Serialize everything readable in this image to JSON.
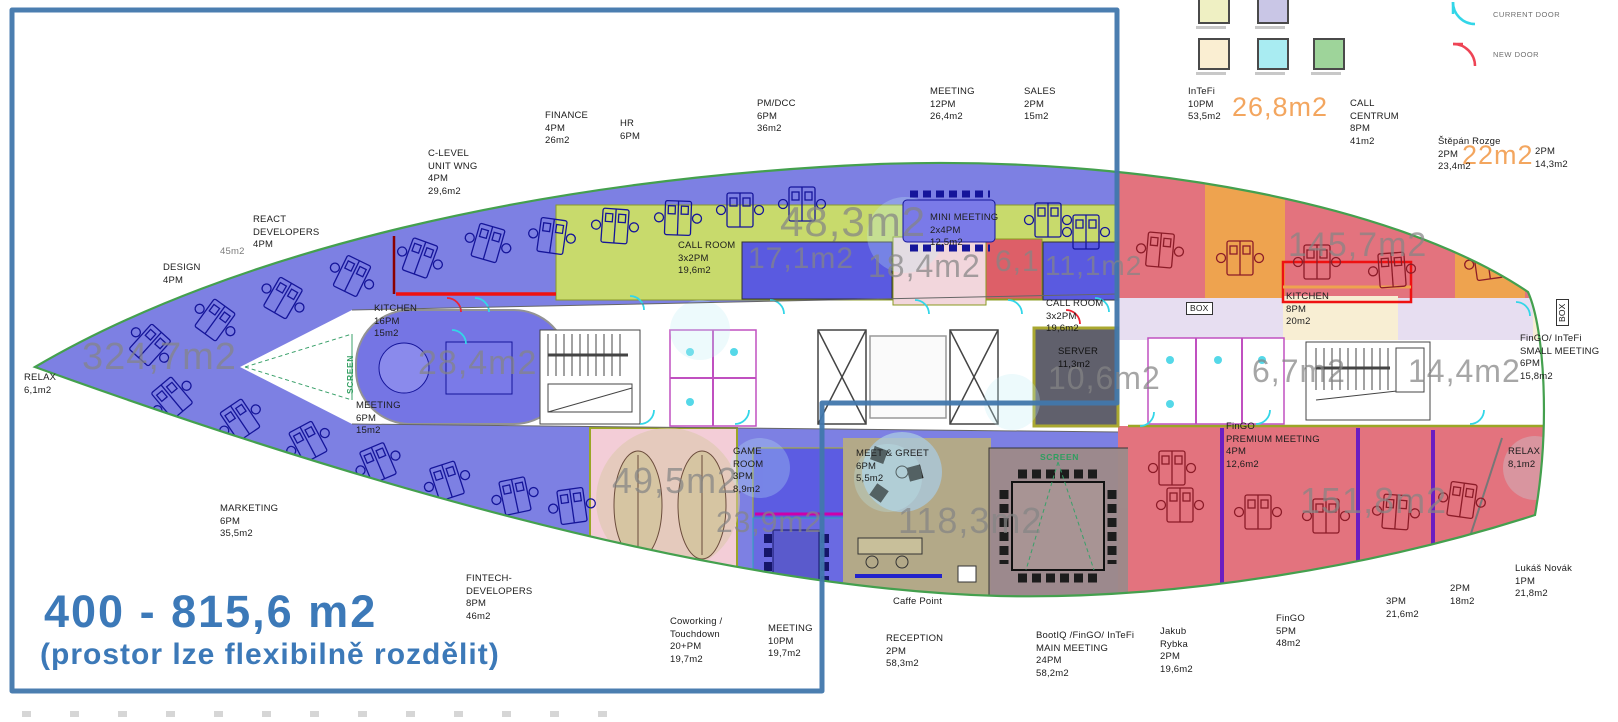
{
  "title": {
    "line1": "400 - 815,6 m2",
    "line2": "(prostor lze flexibilně rozdělit)"
  },
  "legend": {
    "current_door": "CURRENT DOOR",
    "new_door": "NEW DOOR"
  },
  "labels": {
    "finance": "FINANCE\n4PM\n26m2",
    "hr": "HR\n6PM",
    "clevel": "C-LEVEL\nUNIT WNG\n4PM\n29,6m2",
    "pmdcc": "PM/DCC\n6PM\n36m2",
    "meeting12": "MEETING\n12PM\n26,4m2",
    "sales": "SALES\n2PM\n15m2",
    "react": "REACT\nDEVELOPERS\n4PM",
    "area45": "45m2",
    "design": "DESIGN\n4PM",
    "relax_left": "RELAX\n6,1m2",
    "kitchen_left": "KITCHEN\n16PM\n15m2",
    "meeting6": "MEETING\n6PM\n15m2",
    "screen_left": "SCREEN",
    "callroom_left": "CALL ROOM\n3x2PM\n19,6m2",
    "minimeeting": "MINI MEETING\n2x4PM\n12,5m2",
    "callroom_right": "CALL ROOM\n3x2PM\n19,6m2",
    "box_left": "BOX",
    "server": "SERVER\n11,3m2",
    "intefi10": "InTeFi\n10PM\n53,5m2",
    "callcentrum": "CALL\nCENTRUM\n8PM\n41m2",
    "stepan": "Štěpán Rozge\n2PM\n23,4m2",
    "pm2_top": "2PM\n14,3m2",
    "kitchen_right": "KITCHEN\n8PM\n20m2",
    "box_right": "BOX",
    "fingo_small": "FinGO/ InTeFi\nSMALL MEETING\n6PM\n15,8m2",
    "relax_right": "RELAX\n8,1m2",
    "fingo_premium": "FinGO\nPREMIUM MEETING\n4PM\n12,6m2",
    "marketing": "MARKETING\n6PM\n35,5m2",
    "fintech": "FINTECH-\nDEVELOPERS\n8PM\n46m2",
    "gameroom": "GAME\nROOM\n3PM\n8,9m2",
    "meetgreet": "MEET & GREET\n6PM\n5,5m2",
    "screen_right": "SCREEN",
    "coworking": "Coworking /\nTouchdown\n20+PM\n19,7m2",
    "meeting10": "MEETING\n10PM\n19,7m2",
    "reception": "RECEPTION\n2PM\n58,3m2",
    "caffe": "Caffe Point",
    "mainmeeting": "BootIQ /FinGO/ InTeFi\nMAIN MEETING\n24PM\n58,2m2",
    "jakub": "Jakub\nRybka\n2PM\n19,6m2",
    "fingo5": "FinGO\n5PM\n48m2",
    "pm3": "3PM\n21,6m2",
    "pm2_bottom": "2PM\n18m2",
    "lukas": "Lukáš Novák\n1PM\n21,8m2"
  },
  "areas": {
    "blue_zone": "324,7m2",
    "oval_meeting": "28,4m2",
    "kitchen_zone": "48,3m2",
    "call_room_a": "17,1m2",
    "call_room_b": "18,4m2",
    "call_room_c": "6,1",
    "call_room_d": "11,1m2",
    "server_zone": "10,6m2",
    "call_centrum_zone": "145,7m2",
    "stair_left_room": "6,7m2",
    "stair_right_room": "14,4m2",
    "coworking_room": "49,5m2",
    "meeting10_room": "23,9m2",
    "reception_zone": "118,3m2",
    "fingo_zone": "151,8m2",
    "intefi_zone": "26,8m2",
    "stepan_zone": "22m2"
  }
}
